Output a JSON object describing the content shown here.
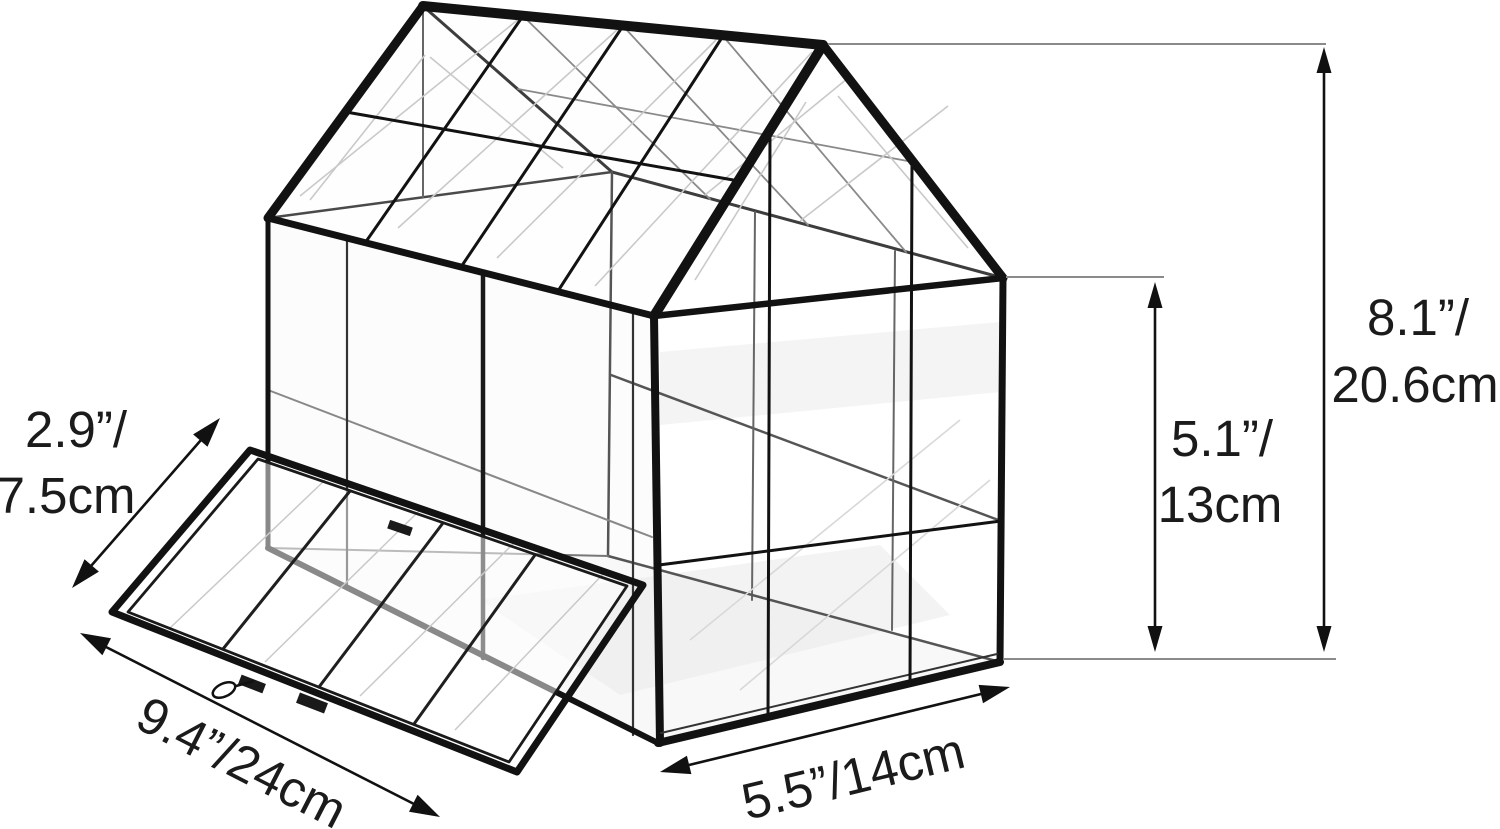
{
  "figure": {
    "background_color": "#ffffff",
    "frame_color": "#121212",
    "interior_line_color": "#555555",
    "extension_line_color": "#8a8a8a",
    "dimension_line_color": "#111111",
    "text_color": "#1b1b1b"
  },
  "dimensions": {
    "door_height": {
      "line1": "2.9”/",
      "line2": "7.5cm"
    },
    "door_width": {
      "label": "9.4”/24cm"
    },
    "base_depth": {
      "label": "5.5”/14cm"
    },
    "side_height": {
      "line1": "5.1”/",
      "line2": "13cm"
    },
    "total_height": {
      "line1": "8.1”/",
      "line2": "20.6cm"
    }
  }
}
